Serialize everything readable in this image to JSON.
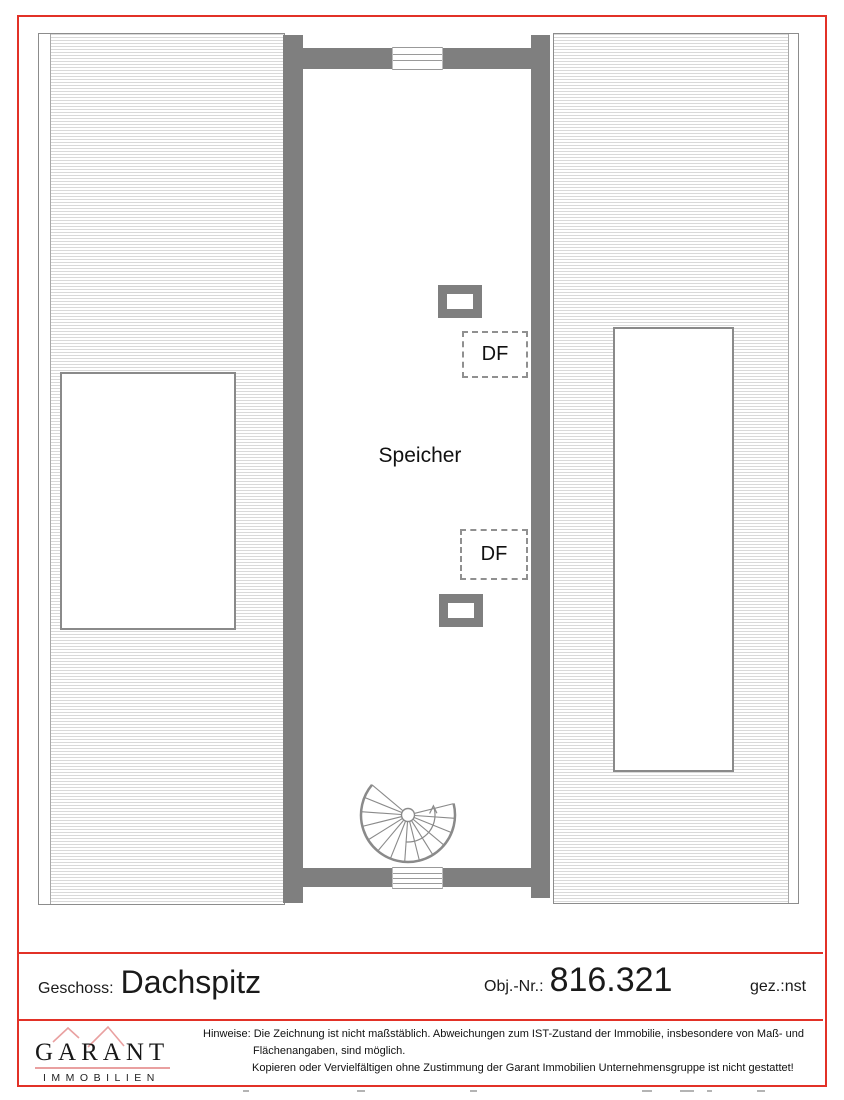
{
  "drawing": {
    "room_label": "Speicher",
    "df_boxes": [
      {
        "label": "DF"
      },
      {
        "label": "DF"
      }
    ]
  },
  "title_block": {
    "floor_label": "Geschoss:",
    "floor_value": "Dachspitz",
    "object_number_label": "Obj.-Nr.:",
    "object_number_value": "816.321",
    "drawn_by": "gez.:nst"
  },
  "footer": {
    "logo": {
      "title": "GARANT",
      "subtitle": "IMMOBILIEN",
      "icon": "garant-roof-icon"
    },
    "notes_line1": "Hinweise: Die Zeichnung ist nicht maßstäblich. Abweichungen zum IST-Zustand der Immobilie, insbesondere von Maß- und",
    "notes_line2": "Flächenangaben, sind möglich.",
    "notes_line3": "Kopieren oder Vervielfältigen ohne Zustimmung der Garant Immobilien Unternehmensgruppe ist nicht gestattet!"
  },
  "colors": {
    "frame-red": "#e23127",
    "wall-gray": "#7f7f7f",
    "hatch-line": "#d9d9d9",
    "line-gray": "#8c8c8c",
    "logo-pink": "#e9a0a0",
    "text-black": "#1a1a1a"
  }
}
